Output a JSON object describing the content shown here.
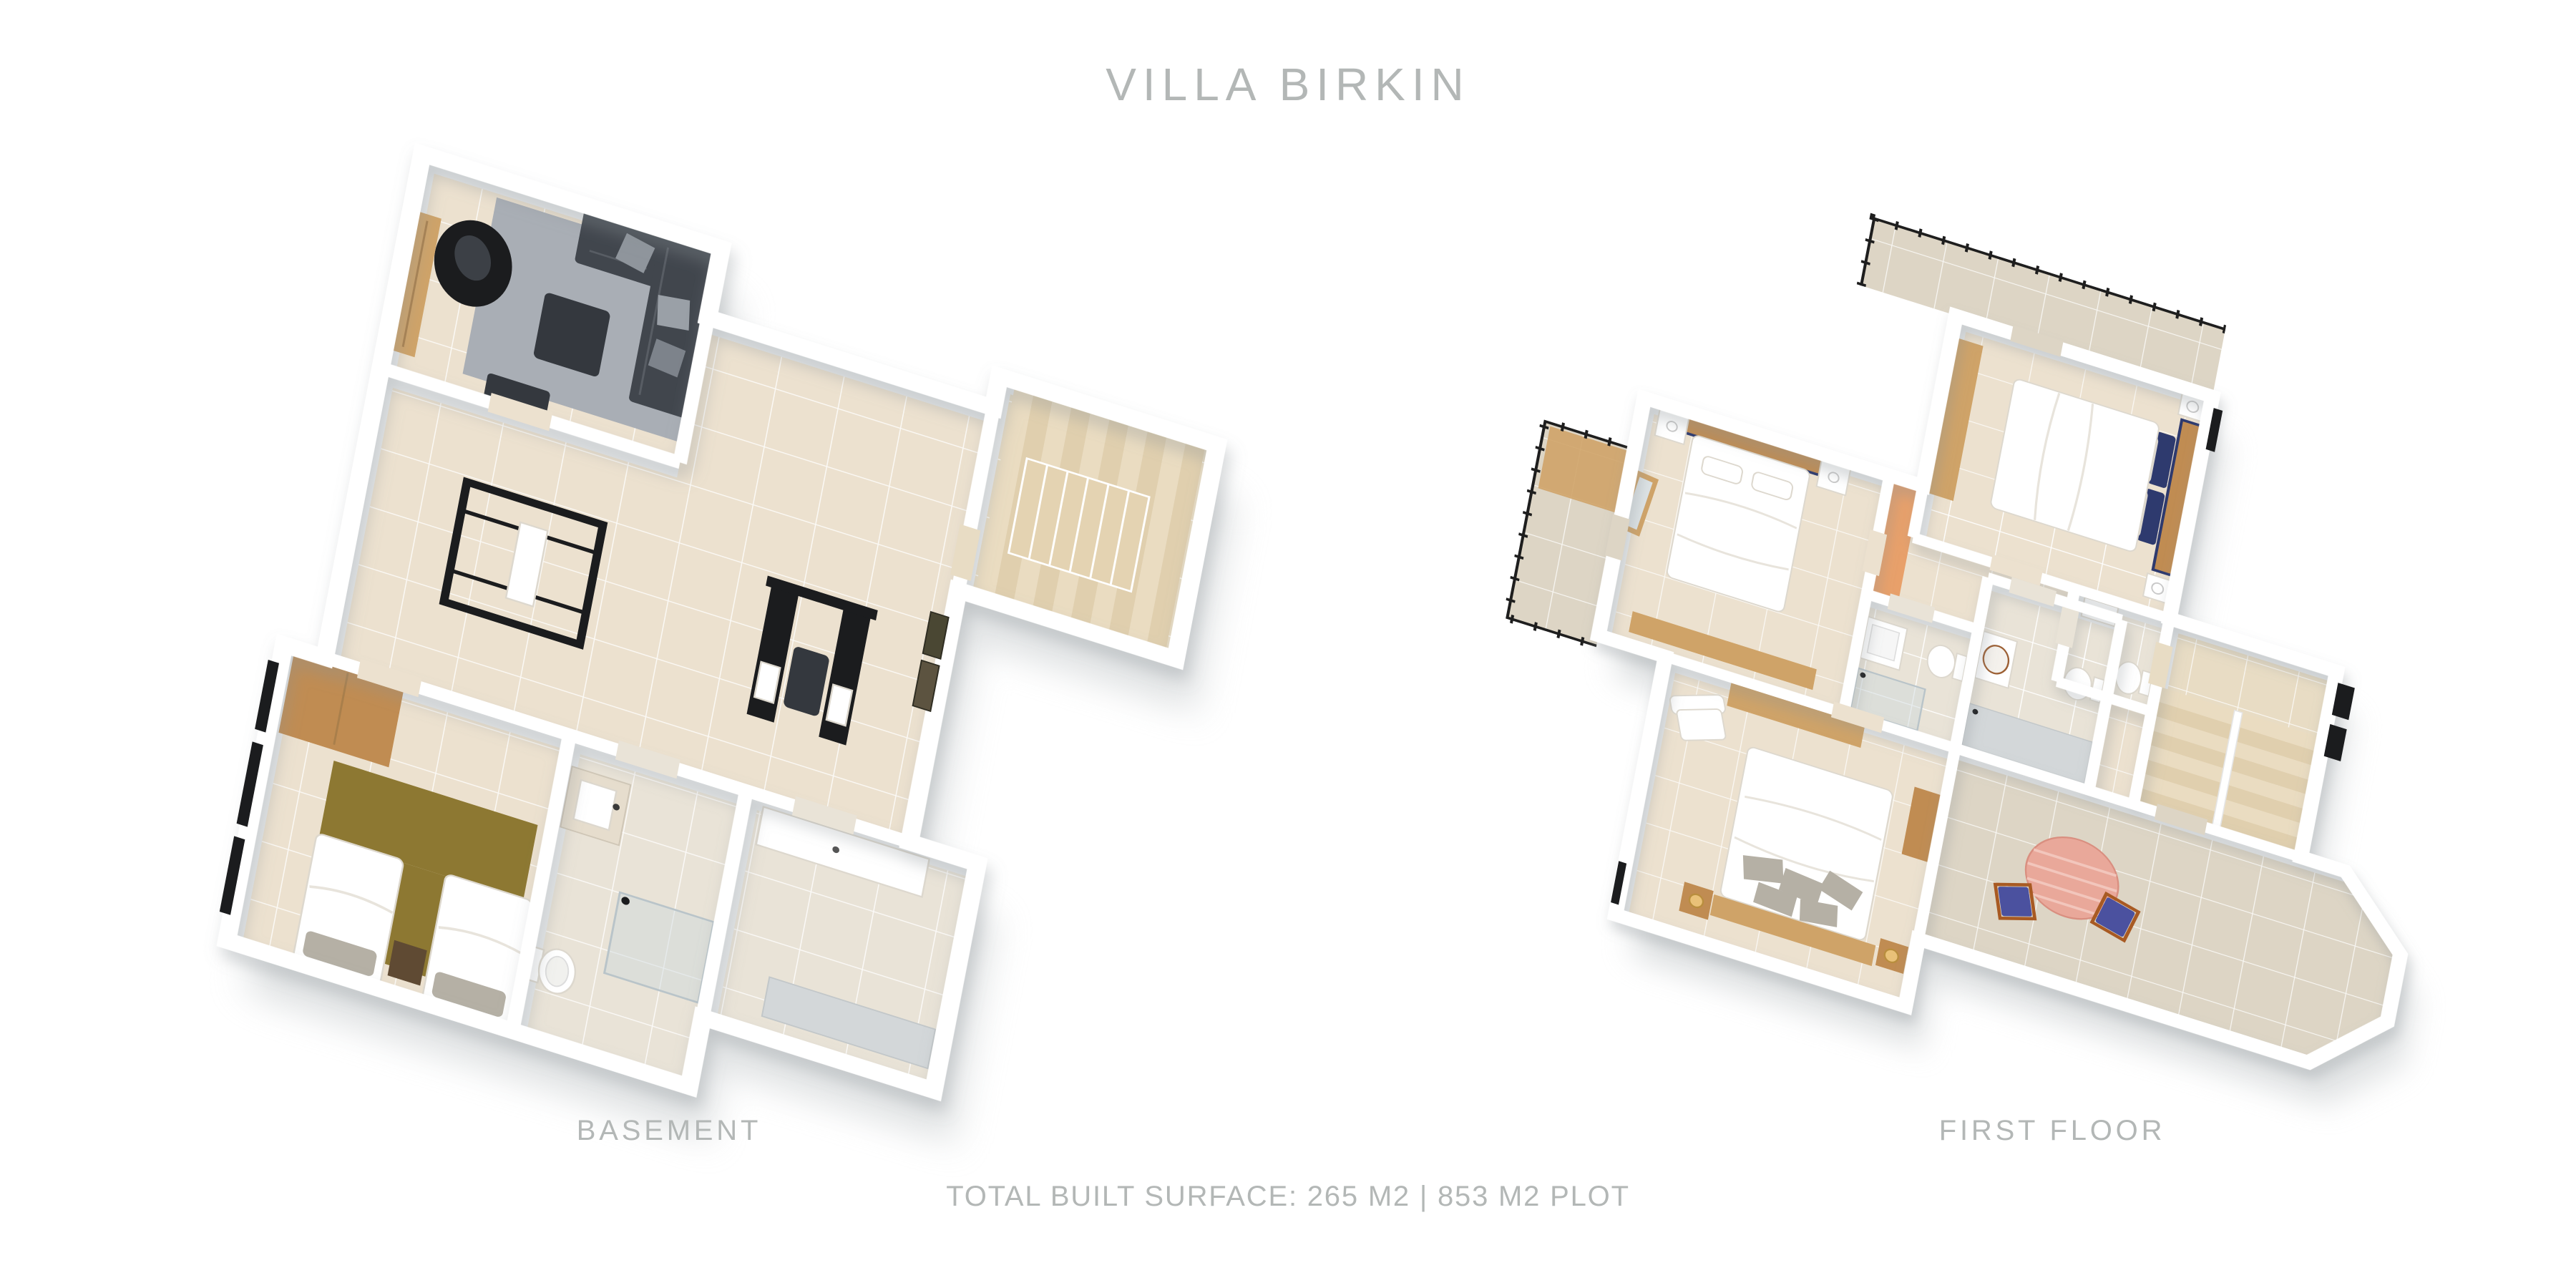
{
  "title": "VILLA BIRKIN",
  "plans": [
    {
      "id": "basement",
      "label": "BASEMENT"
    },
    {
      "id": "first_floor",
      "label": "FIRST FLOOR"
    }
  ],
  "footer": {
    "text": "TOTAL BUILT SURFACE: 265 M2  | 853 M2 PLOT",
    "total_built_surface_m2": 265,
    "plot_m2": 853
  },
  "colors": {
    "background": "#ffffff",
    "text_gray": "#b3b7b6",
    "wall_white": "#ffffff",
    "wall_face": "#e9ebec",
    "floor_tile": "#ece1cf",
    "floor_tile_light": "#e9e3d7",
    "terrace_tile": "#ddd5c5",
    "stairs_floor": "#e8dcc4",
    "stair_tread": "#eadcc1",
    "stair_tread_alt": "#e0cfae",
    "rug_gray": "#a9aeb5",
    "rug_olive": "#8d7832",
    "sofa_charcoal": "#41464d",
    "furniture_dark": "#34383e",
    "black": "#1b1c1e",
    "wood_light": "#cfa368",
    "wood_mid": "#c08c52",
    "wood_orange": "#e8a06a",
    "bed_white": "#ffffff",
    "pillow_gray": "#b5b0a5",
    "pillow_navy": "#2e3a6e",
    "marble": "#e6ddcd",
    "glass": "#cdd8dc",
    "tub_gray": "#d3d7d9",
    "table_pink": "#e9a89a",
    "chair_blue": "#4b519f",
    "chair_frame": "#a85a23",
    "railing_black": "#1e1e1e",
    "shadow": "#c7cbcd"
  }
}
